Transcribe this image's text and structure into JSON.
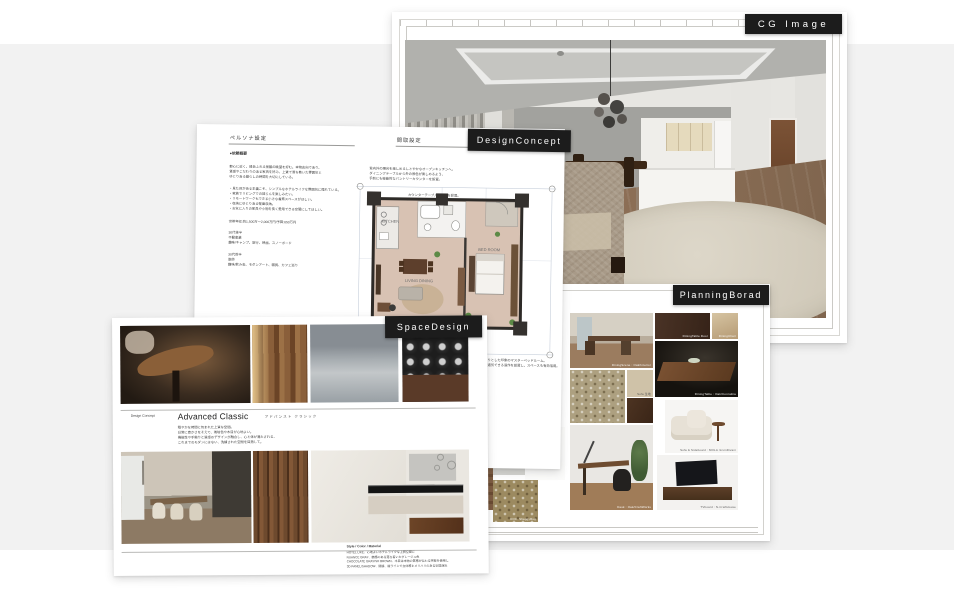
{
  "colors": {
    "background_band": "#f2f2f2",
    "page": "#ffffff",
    "tag_background": "#1c1c1c",
    "tag_text": "#ffffff",
    "plan_floor": "#d8c2b3",
    "wood_accent": "#6e4a2e"
  },
  "tags": {
    "cg_image": "CG Image",
    "design_concept": "DesignConcept",
    "space_design": "SpaceDesign",
    "planning_board": "PlanningBorad"
  },
  "design_concept": {
    "left_header": "ペルソナ設定",
    "right_header": "間取設定",
    "overview_title": "●依頼概要",
    "persona_paragraph": "都心に近く、緑あふれる景観の眺望を好む。本物志向であり、\n質感やこだわりのある家具を好み、上質で落ち着いた雰囲気と\nゆとりある暮らしの時間を大切にしている。",
    "wish_list": "・見た目がある主義こそ、シンプルなホテルライクな雰囲気に憧れている。\n・家族でリビングでの団らんを楽しみたい。\n・リモートワークもできる小さな書斎スペースがほしい。\n・収納にゆとりある壁面収納。\n・お気に入りの家具や小物を長く愛用できる空間にしてほしい。",
    "budget_line": "世帯年収:約1,500万〜2,000万円/予算:650万円",
    "husband_profile": "30代後半\n不動産業\n趣味/キャンプ、旅行、映画、スノーボード",
    "wife_profile": "30代前半\n医師\n趣味/飲み会、モダンアート、雑貨、カフェ巡り",
    "plan_note_top": "室内外の陽光を楽しめるしとやかなオープンキッチンへ。\nダイニングテーブルから外の景色が楽しめるよう、\n手前にも機能的なパントリーカウンターを設置。",
    "plan_note_side": "カウンターテーブルに収納を設置。\n向いのスリッパーには目隠しの扉で、\n暮らしと空間を魅力的に演出。",
    "plan_note_bottom": "すっきりとした印象のマスターベッドルーム。\n中央に通気できる造作を設置し、スペースも有効活用。",
    "room_labels": {
      "kitchen": "KITCHEN",
      "living": "LIVING\nDINING",
      "bedroom": "BED ROOM"
    }
  },
  "space_design": {
    "concept_label": "Design Concept",
    "style_name": "Advanced Classic",
    "style_kana": "アドバンスト クラシック",
    "style_paragraph": "穏やかな時間に包まれた上質な空間。\n日常に豊かさをそえて、琥珀色や木目が心地よい。\n機能性や手触りと質感のデザインが融合し、心と体が満たされる、\nこれまでのモダンにはない、洗練された空間を目指して。",
    "material_title": "Style / Color / Material",
    "material_lines": "HOTEL LIKE、心地よいホテルライクな上質空間に\nNUANCE GRAY、艶感のある落ち着いたグレージュ色\nCHOCOLATE GRAYISH BROWN、木目は本物の質感が伝わる突板を使用し\n3D PANEL/SHADOW、間接、縦ラインで立体感とメリハリのある空間演出"
  },
  "planning_board": {
    "captions": {
      "dining_photo": "DiningScene : Oak/Interior",
      "sample_door": "DiningTable Door",
      "sample_chair": "DiningChair",
      "walnut_table": "DiningTable : Oak/Connubia",
      "sofa_fabric": "Sofa 生地",
      "white_sofa": "Sofa & Sideboard : MOLA /LivinDivani",
      "desk": "Desk : Oak/CraftWorks",
      "tv_board": "TVboard : N-CraftHouse",
      "pendant": "Pendant 26 / CrystalBeiz",
      "wallpaper": "クロス壁 /SANGETSU FE",
      "gold_carpet": "COC. ShaggyRug"
    }
  }
}
